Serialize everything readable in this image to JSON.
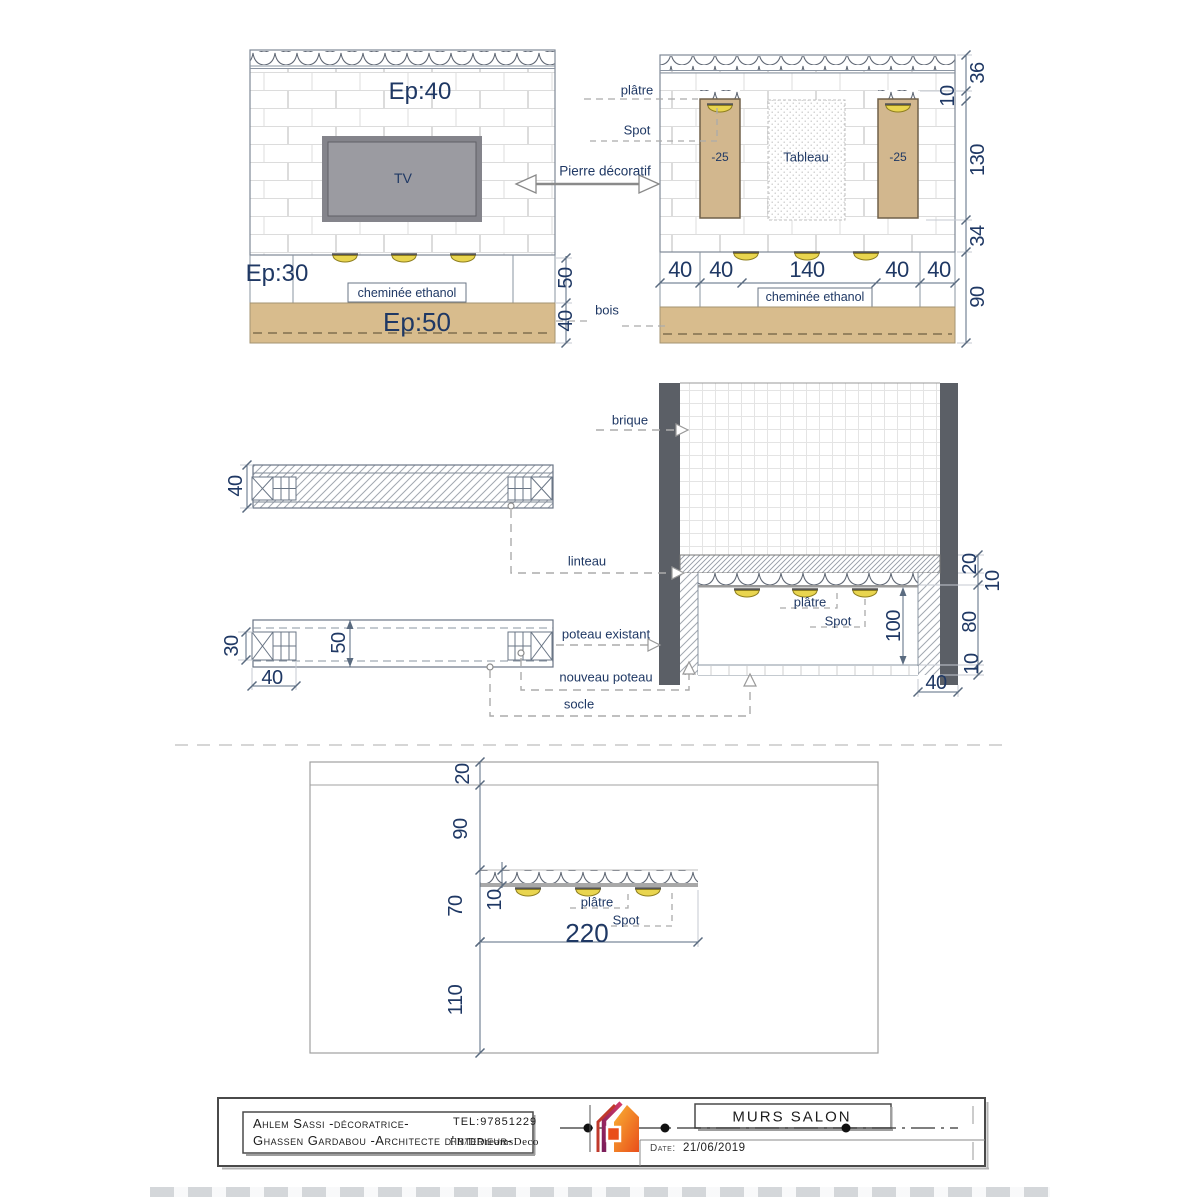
{
  "colors": {
    "text_navy": "#1F3864",
    "tan_wood": "#D8BC8D",
    "tv_gray": "#9B9BA1",
    "column_gray": "#5B5F66",
    "spot_yellow": "#E9D54F",
    "logo_orange": "#EE7B1C",
    "logo_purple": "#9C1C60"
  },
  "elevation_left": {
    "ep_top": "Ep:40",
    "tv_label": "TV",
    "ep_mid": "Ep:30",
    "cheminee_label": "cheminée ethanol",
    "ep_base": "Ep:50",
    "dim_band": "50",
    "dim_base": "40"
  },
  "elevation_right": {
    "platre_label": "plâtre",
    "spot_label": "Spot",
    "pierre_label": "Pierre décoratif",
    "niche_left_label": "-25",
    "niche_right_label": "-25",
    "tableau_label": "Tableau",
    "cheminee_label": "cheminée ethanol",
    "bois_label": "bois",
    "dims_bottom": [
      "40",
      "40",
      "140",
      "40",
      "40"
    ],
    "dim_36": "36",
    "dim_10": "10",
    "dim_130": "130",
    "dim_34": "34",
    "dim_90": "90"
  },
  "beam_plan": {
    "dim_40_top": "40",
    "dim_30": "30",
    "dim_50": "50",
    "dim_40_bottom": "40"
  },
  "section": {
    "brique_label": "brique",
    "linteau_label": "linteau",
    "poteau_existant_label": "poteau existant",
    "nouveau_poteau_label": "nouveau poteau",
    "socle_label": "socle",
    "platre_label": "plâtre",
    "spot_label": "Spot",
    "dim_100": "100",
    "dim_20": "20",
    "dim_10_top": "10",
    "dim_80": "80",
    "dim_10_bottom": "10",
    "dim_40": "40"
  },
  "plan": {
    "dim_20": "20",
    "dim_90": "90",
    "dim_70": "70",
    "dim_10": "10",
    "dim_110": "110",
    "dim_220": "220",
    "platre_label": "plâtre",
    "spot_label": "Spot"
  },
  "titleblock": {
    "designer_line1": "Ahlem Sassi -décoratrice-",
    "designer_line2": "Ghassen Gardabou -Architecte d'interieur-",
    "tel": "TEL:97851229",
    "fb": "FB/DDreamsDeco",
    "project_title": "MURS SALON",
    "date_label": "Date:",
    "date_value": "21/06/2019"
  }
}
